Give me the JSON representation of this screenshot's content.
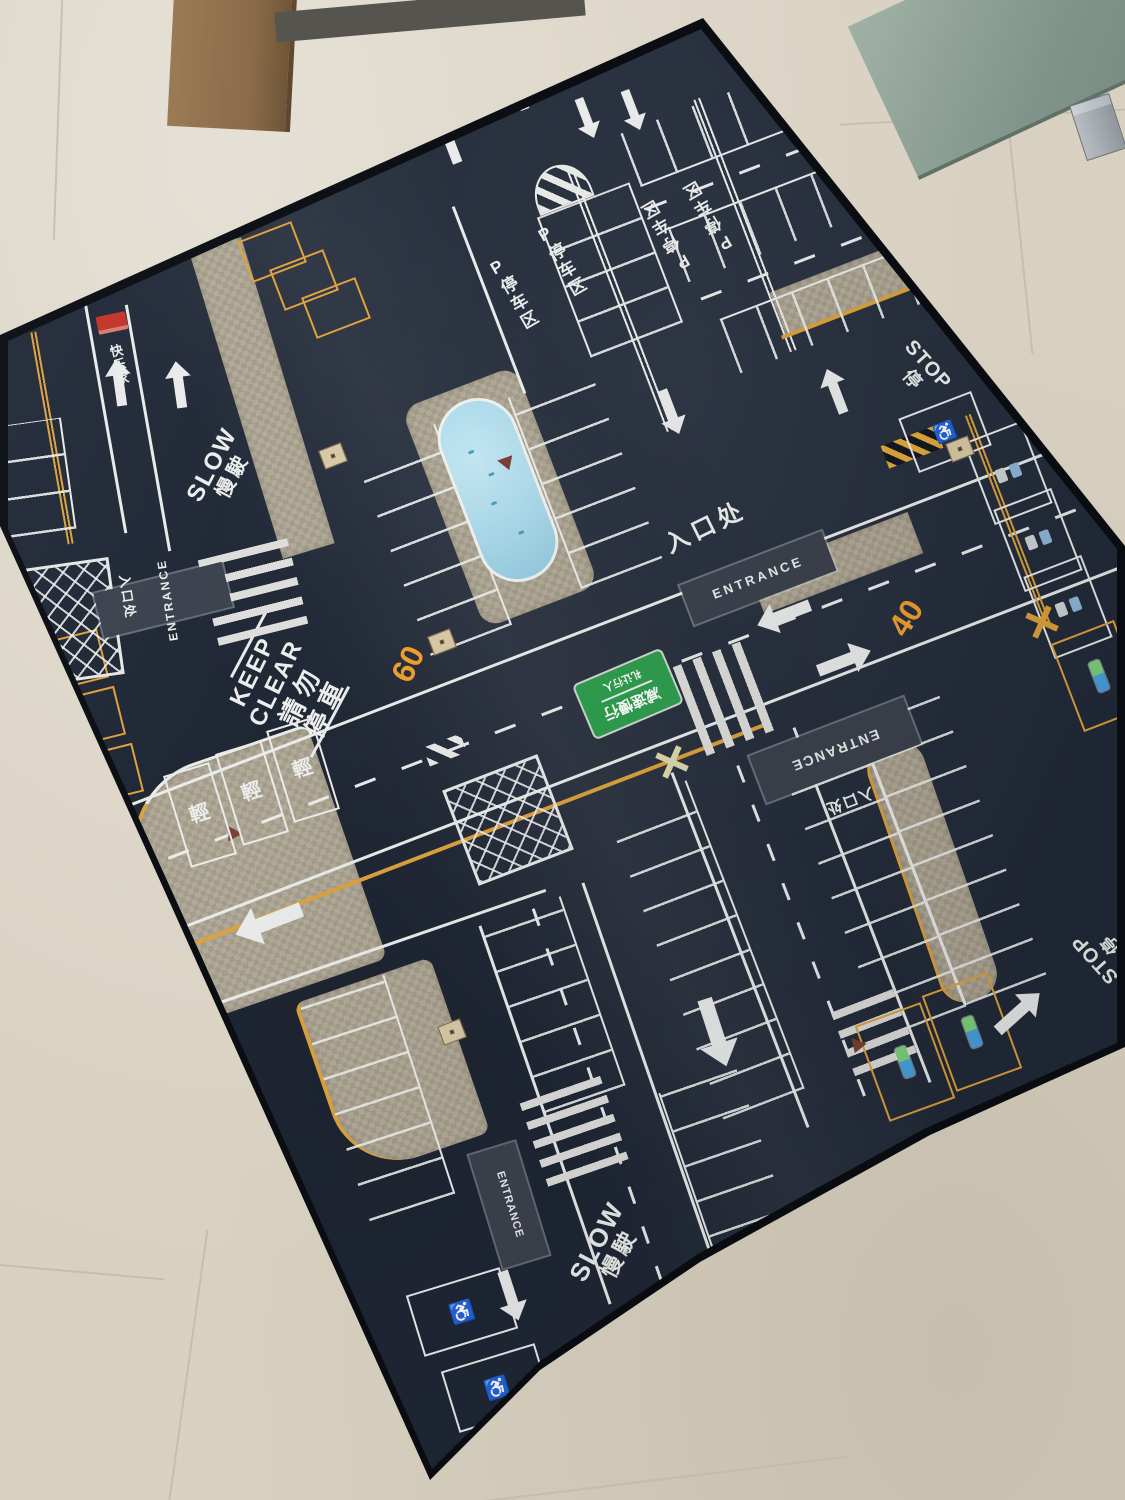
{
  "colors": {
    "floor_tile": "#d8d0c0",
    "grout": "#c2b9a7",
    "door_wood": "#8f6f4e",
    "glass_panel": "#8aa095",
    "mat_surface": "#222a39",
    "mat_edge": "#0a0d12",
    "marking_white": "#e9ebea",
    "marking_yellow": "#dba23d",
    "speed_orange": "#ef9f2e",
    "sidewalk_gray": "#b2aa98",
    "pool_blue": "#a7d7e8",
    "green_sign": "#2f9e4f",
    "entrance_band": "#3c424d",
    "logo_red": "#c23527"
  },
  "brand": {
    "vertical_text": "快乐家"
  },
  "markings": {
    "slow_en": "SLOW",
    "slow_zh": "慢駛",
    "keep_clear_en_1": "KEEP",
    "keep_clear_en_2": "CLEAR",
    "keep_clear_zh_1": "請勿",
    "keep_clear_zh_2": "停車",
    "stop_en": "STOP",
    "stop_zh": "停",
    "entrance_en": "ENTRANCE",
    "entrance_zh": "入口处",
    "parking_zone_vertical": "P停车区",
    "speed_60": "60",
    "speed_40": "40",
    "light_vehicle_stall": "輕"
  },
  "signs": {
    "green_sign_line_1": "减速慢行",
    "green_sign_line_2": "礼让行人"
  },
  "symbols": {
    "wheelchair": "♿"
  }
}
